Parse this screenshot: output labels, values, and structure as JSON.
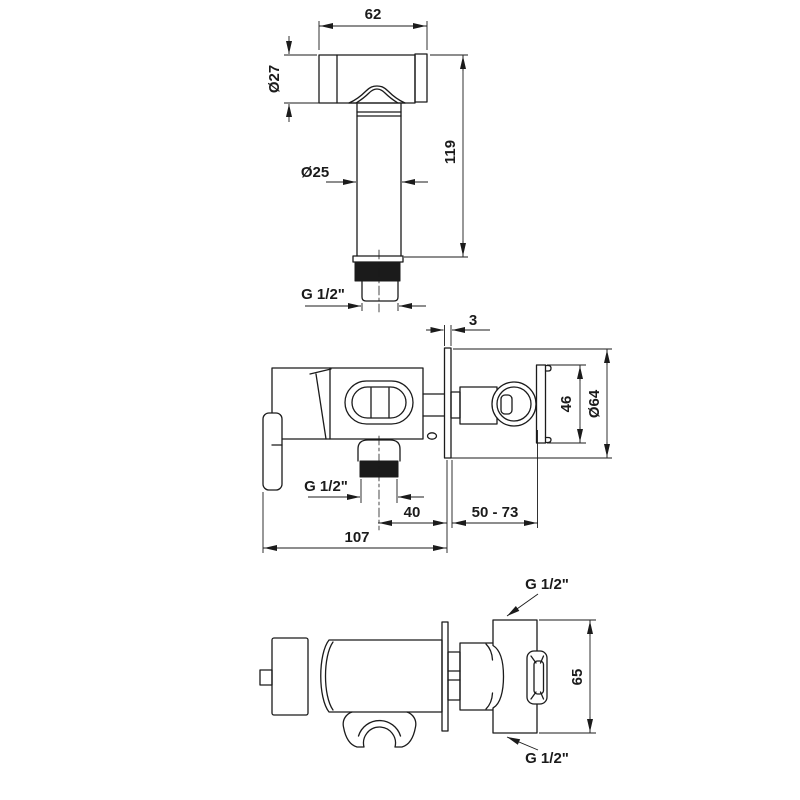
{
  "views": {
    "sprayer": {
      "dims": {
        "head_width": "62",
        "head_diameter": "Ø27",
        "handle_diameter": "Ø25",
        "total_length": "119",
        "thread": "G 1/2\""
      }
    },
    "side": {
      "dims": {
        "plate_thickness": "3",
        "holder_height": "46",
        "plate_diameter": "Ø64",
        "outlet_thread": "G 1/2\"",
        "outlet_to_wall": "40",
        "installation_depth": "50 - 73",
        "total_depth": "107"
      }
    },
    "top": {
      "dims": {
        "inlet_thread_top": "G 1/2\"",
        "body_height": "65",
        "inlet_thread_bottom": "G 1/2\""
      }
    }
  }
}
